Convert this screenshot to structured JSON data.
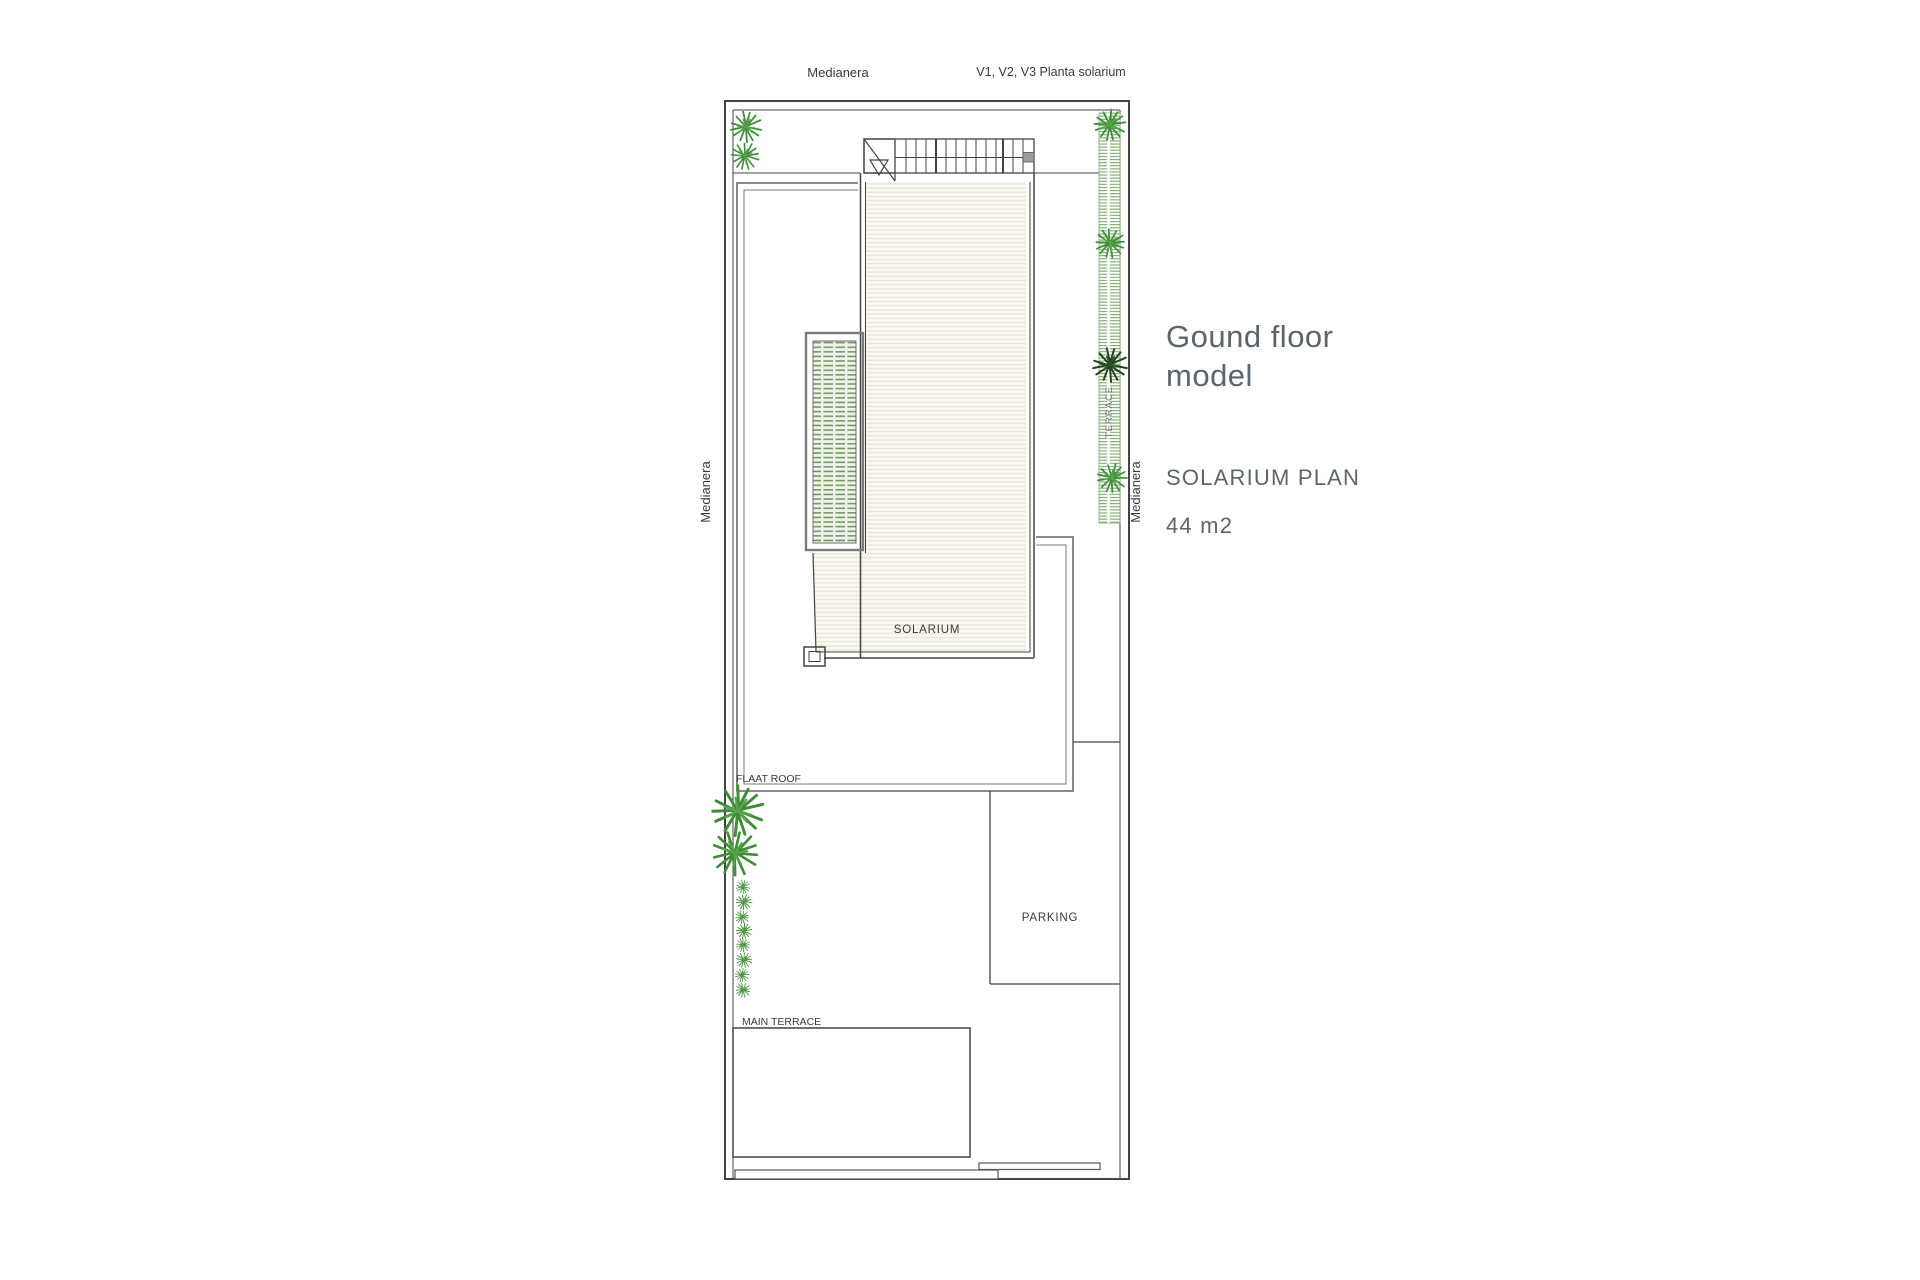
{
  "annotations": {
    "medianera_top": "Medianera",
    "planta_note": "V1, V2, V3 Planta solarium",
    "medianera_left": "Medianera",
    "medianera_right": "Medianera"
  },
  "rooms": {
    "solarium": "SOLARIUM",
    "flat_roof": "FLAAT ROOF",
    "parking": "PARKING",
    "main_terrace": "MAIN TERRACE",
    "terrace": "TERRACE"
  },
  "title_block": {
    "title_line1": "Gound floor",
    "title_line2": "model",
    "plan_name": "SOLARIUM PLAN",
    "area": "44 m2"
  },
  "colors": {
    "line-dark": "#434343",
    "wall-gray": "#7a7a7a",
    "text-dark": "#3a3a3a",
    "text-muted": "#6e6e6e",
    "title-gray": "#5b656b",
    "plant-green": "#3f8d38",
    "plant-green-light": "#58a44b",
    "plant-dark": "#24421f",
    "hedge-green": "#7cab6d",
    "pergola-green": "#6f9460",
    "pergola-bg": "#eef3e9",
    "deck-bg": "#faf8f3",
    "deck-line": "#e9e2d2",
    "pool-fill": "#cde7f0",
    "pool-stripe": "#b2d5e1",
    "canvas-bg": "#ffffff"
  }
}
